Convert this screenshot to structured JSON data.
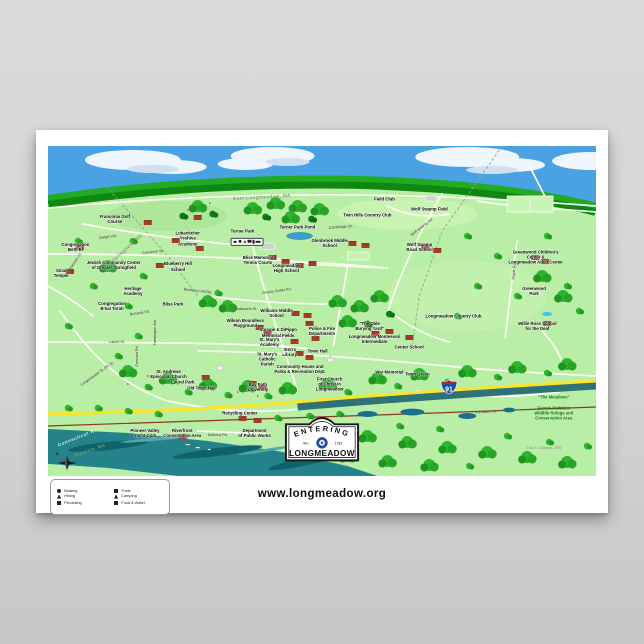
{
  "poster": {
    "footer": {
      "website": "www.longmeadow.org"
    },
    "compass_label": "N",
    "interstate_number": "91",
    "sign": {
      "entering": "ENTERING",
      "inc": "INC.",
      "year": "1783",
      "name": "LONGMEADOW"
    },
    "colors": {
      "sky": "#4aa2e2",
      "land": "#b9eea6",
      "river": "#24838a",
      "route_yellow": "#f6e630",
      "highway": "#2f7277",
      "railroad": "#8a3b22",
      "tree": "#2fb42e",
      "building": "#a83a2a"
    },
    "facility_box_icons": [
      {
        "icon": "picnic-table-icon"
      },
      {
        "icon": "restrooms-icon"
      },
      {
        "icon": "playground-icon"
      },
      {
        "icon": "tennis-icon"
      },
      {
        "icon": "trails-icon"
      },
      {
        "icon": "parking-icon"
      }
    ],
    "legend": {
      "items": [
        {
          "icon": "boating-icon",
          "shape": "round",
          "label": "Boating"
        },
        {
          "icon": "trails-icon",
          "shape": "sq",
          "label": "Trails"
        },
        {
          "icon": "hiking-icon",
          "shape": "tri",
          "label": "Hiking"
        },
        {
          "icon": "camping-icon",
          "shape": "tri",
          "label": "Camping"
        },
        {
          "icon": "picnic-icon",
          "shape": "table",
          "label": "Picnicking"
        },
        {
          "icon": "food-water-icon",
          "shape": "wide",
          "label": "Food & Water"
        }
      ]
    },
    "map": {
      "labels": [
        {
          "t": "East Longmeadow, MA",
          "x": 39,
          "y": 15.5,
          "c": "region",
          "r": -3
        },
        {
          "t": "Franconia Golf\nCourse",
          "x": 12.2,
          "y": 22,
          "c": "place"
        },
        {
          "t": "Dwight Rd.",
          "x": 11,
          "y": 27.5,
          "c": "street",
          "r": -7
        },
        {
          "t": "Congregation\nBeth El",
          "x": 5,
          "y": 30.5,
          "c": "place"
        },
        {
          "t": "Springfield, MA",
          "x": 14.5,
          "y": 31,
          "c": "region",
          "r": -42
        },
        {
          "t": "Converse St.",
          "x": 19.2,
          "y": 32,
          "c": "street",
          "r": -6
        },
        {
          "t": "Dickinson St.",
          "x": 5,
          "y": 35.2,
          "c": "street",
          "r": -55
        },
        {
          "t": "Lubavitcher\nYeshiva\nAcademy",
          "x": 25.5,
          "y": 28,
          "c": "place"
        },
        {
          "t": "Jewish Community Center\nof Greater Springfield",
          "x": 12,
          "y": 36,
          "c": "place"
        },
        {
          "t": "Sinai\nTemple",
          "x": 2.4,
          "y": 38.5,
          "c": "place"
        },
        {
          "t": "Blueberry Hill\nSchool",
          "x": 23.7,
          "y": 36.5,
          "c": "place"
        },
        {
          "t": "Heritage\nAcademy",
          "x": 15.5,
          "y": 44,
          "c": "place"
        },
        {
          "t": "Congregation\nB'nai Torah",
          "x": 11.7,
          "y": 48.5,
          "c": "place"
        },
        {
          "t": "Bliss Park",
          "x": 22.8,
          "y": 48,
          "c": "place"
        },
        {
          "t": "Burbank Rd.",
          "x": 16.8,
          "y": 50.5,
          "c": "street",
          "r": -9
        },
        {
          "t": "Laurel St.",
          "x": 12.6,
          "y": 59.5,
          "c": "street"
        },
        {
          "t": "Farmington Ave.",
          "x": 19.5,
          "y": 56.5,
          "c": "street",
          "r": -90
        },
        {
          "t": "Crescent Rd.",
          "x": 16.2,
          "y": 63.5,
          "c": "street",
          "r": -90
        },
        {
          "t": "Longmeadow St. (Rt. 5)",
          "x": 9,
          "y": 69,
          "c": "street",
          "r": -35
        },
        {
          "t": "St. Andrews\nEpiscopal Church",
          "x": 22,
          "y": 69,
          "c": "place"
        },
        {
          "t": "Laurel Park",
          "x": 24.6,
          "y": 71.5,
          "c": "place"
        },
        {
          "t": "Old Town Hall",
          "x": 28,
          "y": 73.2,
          "c": "place"
        },
        {
          "t": "Bay Path\nUniversity",
          "x": 38.3,
          "y": 73,
          "c": "place"
        },
        {
          "t": "Turner Park",
          "x": 35.5,
          "y": 25.8,
          "c": "place"
        },
        {
          "t": "Bliss Memorial\nTennis Courts",
          "x": 38.3,
          "y": 34.5,
          "c": "place"
        },
        {
          "t": "Longmeadow\nHigh School",
          "x": 43.5,
          "y": 37,
          "c": "place"
        },
        {
          "t": "Turner Park Pond",
          "x": 45.5,
          "y": 24.5,
          "c": "place"
        },
        {
          "t": "Cambridge Cir.",
          "x": 53.5,
          "y": 24.5,
          "c": "street",
          "r": -4
        },
        {
          "t": "Twin Hills Country Club",
          "x": 58.3,
          "y": 21,
          "c": "place"
        },
        {
          "t": "Field Club",
          "x": 61.4,
          "y": 16,
          "c": "place"
        },
        {
          "t": "Wolf Swamp Field",
          "x": 69.6,
          "y": 19,
          "c": "place"
        },
        {
          "t": "Glenbrook Middle\nSchool",
          "x": 51.4,
          "y": 29.5,
          "c": "place"
        },
        {
          "t": "Grassy Gutter Rd.",
          "x": 41.7,
          "y": 44,
          "c": "street",
          "r": -8
        },
        {
          "t": "Blueberry Hill Rd.",
          "x": 27.3,
          "y": 44,
          "c": "street",
          "r": 7
        },
        {
          "t": "Wadsworth St.",
          "x": 36,
          "y": 49.5,
          "c": "street"
        },
        {
          "t": "Williams Middle\nSchool",
          "x": 41.7,
          "y": 50.5,
          "c": "place"
        },
        {
          "t": "Wilson Boundless\nPlayground",
          "x": 36,
          "y": 53.5,
          "c": "place"
        },
        {
          "t": "Stoogie & DiPippo\nMemorial Fields",
          "x": 42,
          "y": 56.5,
          "c": "place"
        },
        {
          "t": "St. Mary's\nAcademy",
          "x": 40.4,
          "y": 59.5,
          "c": "place"
        },
        {
          "t": "St. Mary's\nCatholic\nParish",
          "x": 40,
          "y": 64.5,
          "c": "place"
        },
        {
          "t": "Storrs\nLibrary",
          "x": 44.1,
          "y": 62.5,
          "c": "place"
        },
        {
          "t": "Town Hall",
          "x": 49.2,
          "y": 62,
          "c": "place"
        },
        {
          "t": "Police & Fire\nDepartments",
          "x": 50,
          "y": 56,
          "c": "place"
        },
        {
          "t": "\"The Olde\nBurying Yard\"",
          "x": 58.7,
          "y": 54.5,
          "c": "place"
        },
        {
          "t": "Longmeadow Montessori\nIntermediate",
          "x": 59.6,
          "y": 58.5,
          "c": "place"
        },
        {
          "t": "Center School",
          "x": 65.9,
          "y": 61,
          "c": "place"
        },
        {
          "t": "Community House and\nParks & Recreation Dept.",
          "x": 46,
          "y": 67.5,
          "c": "place"
        },
        {
          "t": "First Church\nof Christ in\nLongmeadow",
          "x": 51.4,
          "y": 72,
          "c": "place"
        },
        {
          "t": "War Memorial",
          "x": 62.3,
          "y": 68.5,
          "c": "place"
        },
        {
          "t": "Town Green",
          "x": 67.4,
          "y": 69,
          "c": "place"
        },
        {
          "t": "Wolf Swamp Rd.",
          "x": 68.3,
          "y": 24.5,
          "c": "street",
          "r": -38
        },
        {
          "t": "Wolf Swamp\nRoad School",
          "x": 67.8,
          "y": 30.5,
          "c": "place"
        },
        {
          "t": "Greenwood Children's Center &\nLongmeadow Adult Center",
          "x": 89,
          "y": 33.5,
          "c": "place"
        },
        {
          "t": "Greenwood\nPark",
          "x": 88.7,
          "y": 44,
          "c": "place"
        },
        {
          "t": "Maple Rd.",
          "x": 85,
          "y": 38,
          "c": "street",
          "r": -85
        },
        {
          "t": "Longmeadow Country Club",
          "x": 74,
          "y": 51.5,
          "c": "place"
        },
        {
          "t": "Willie Ross School\nfor the Deaf",
          "x": 89.3,
          "y": 54.5,
          "c": "place"
        },
        {
          "t": "\"The Meadows\"",
          "x": 92.3,
          "y": 76,
          "c": "green"
        },
        {
          "t": "Fannie Stebbins\nWildlife Refuge and\nConservation Area",
          "x": 92.3,
          "y": 81,
          "c": "green"
        },
        {
          "t": "Pondside Rd.",
          "x": 80,
          "y": 80.5,
          "c": "street",
          "r": -4
        },
        {
          "t": "Recycling Center",
          "x": 35,
          "y": 81,
          "c": "place"
        },
        {
          "t": "Pioneer Valley\nYacht Club",
          "x": 17.7,
          "y": 87,
          "c": "place"
        },
        {
          "t": "Riverfront\nConservation Area",
          "x": 24.5,
          "y": 87,
          "c": "place"
        },
        {
          "t": "Anthony Rd.",
          "x": 31,
          "y": 87.5,
          "c": "street"
        },
        {
          "t": "Department\nof Public Works",
          "x": 37.7,
          "y": 87,
          "c": "place"
        },
        {
          "t": "Connecticut River",
          "x": 6,
          "y": 88,
          "c": "water",
          "r": -22
        },
        {
          "t": "Agawam, MA",
          "x": 7.7,
          "y": 92.2,
          "c": "region2",
          "r": -18
        },
        {
          "t": "©Jim B. Calogrias, 2004",
          "x": 90.5,
          "y": 91.5,
          "c": "credit"
        }
      ]
    }
  }
}
